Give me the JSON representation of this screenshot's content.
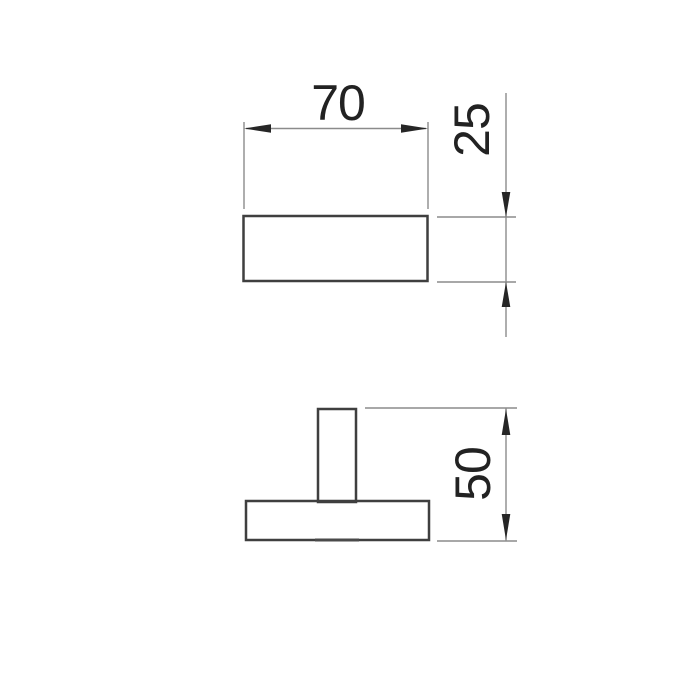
{
  "drawing": {
    "background": "#ffffff",
    "colors": {
      "outline": "#3f3f3f",
      "dimension_line": "#8b8b8b",
      "arrowhead": "#262626",
      "label_text": "#222222"
    },
    "dimensions": {
      "top_width": {
        "value": "70"
      },
      "top_depth": {
        "value": "25"
      },
      "front_height": {
        "value": "50"
      }
    }
  }
}
